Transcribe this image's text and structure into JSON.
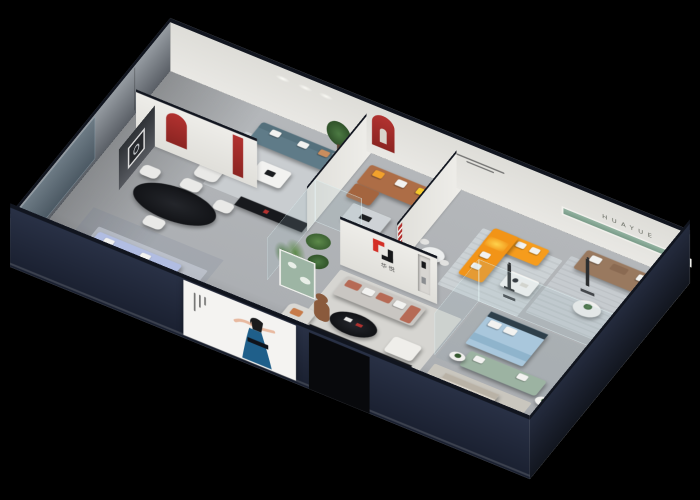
{
  "brand": {
    "logo_text": "华悦",
    "wall_lettering": "HUAYUE"
  },
  "palette": {
    "background": "#000000",
    "facade_navy": "#1f2636",
    "roof_cap_navy": "#11151f",
    "interior_wall_white": "#eceae6",
    "floor_gray": "#b4b7ba",
    "accent_red": "#b23230",
    "logo_red": "#d42f26",
    "logo_black": "#17181a",
    "sofa_orange": "#f69c1c",
    "sofa_caramel": "#ad6d46",
    "sofa_teal": "#5f7b88",
    "sofa_periwinkle": "#b1bde2",
    "sofa_taupe": "#99795f",
    "sofa_terracotta": "#b66a55",
    "sofa_sage": "#9cb3a2",
    "bed_blue": "#a9c7dc",
    "bed_beige": "#d9d3c9",
    "green_shelf_strip": "#86a694",
    "poster_dress_blue": "#1f5f8a",
    "glass_tint": "rgba(160,190,200,0.16)"
  },
  "rooms": [
    {
      "id": "lounge-display",
      "main_colors": [
        "#5f7b88",
        "#e9e9e7"
      ]
    },
    {
      "id": "dining-display",
      "main_colors": [
        "#1c1e22",
        "#e9e9e7"
      ]
    },
    {
      "id": "window-display",
      "main_colors": [
        "#b1bde2",
        "#15171b"
      ]
    },
    {
      "id": "caramel-sofa-display",
      "main_colors": [
        "#ad6d46",
        "#f2a12c"
      ]
    },
    {
      "id": "glass-atrium",
      "main_colors": [
        "#5d8a4a"
      ]
    },
    {
      "id": "orange-sectional-display",
      "main_colors": [
        "#f69c1c"
      ]
    },
    {
      "id": "taupe-sofa-display",
      "main_colors": [
        "#99795f",
        "#86a694"
      ]
    },
    {
      "id": "glass-bedroom-display",
      "main_colors": [
        "#a9c7dc",
        "#9cb3a2"
      ]
    },
    {
      "id": "brand-living-display",
      "main_colors": [
        "#b66a55",
        "#1a1c20"
      ]
    },
    {
      "id": "white-bed-display",
      "main_colors": [
        "#e7e6e3"
      ]
    },
    {
      "id": "beige-bedroom-display",
      "main_colors": [
        "#d9d3c9"
      ]
    }
  ]
}
